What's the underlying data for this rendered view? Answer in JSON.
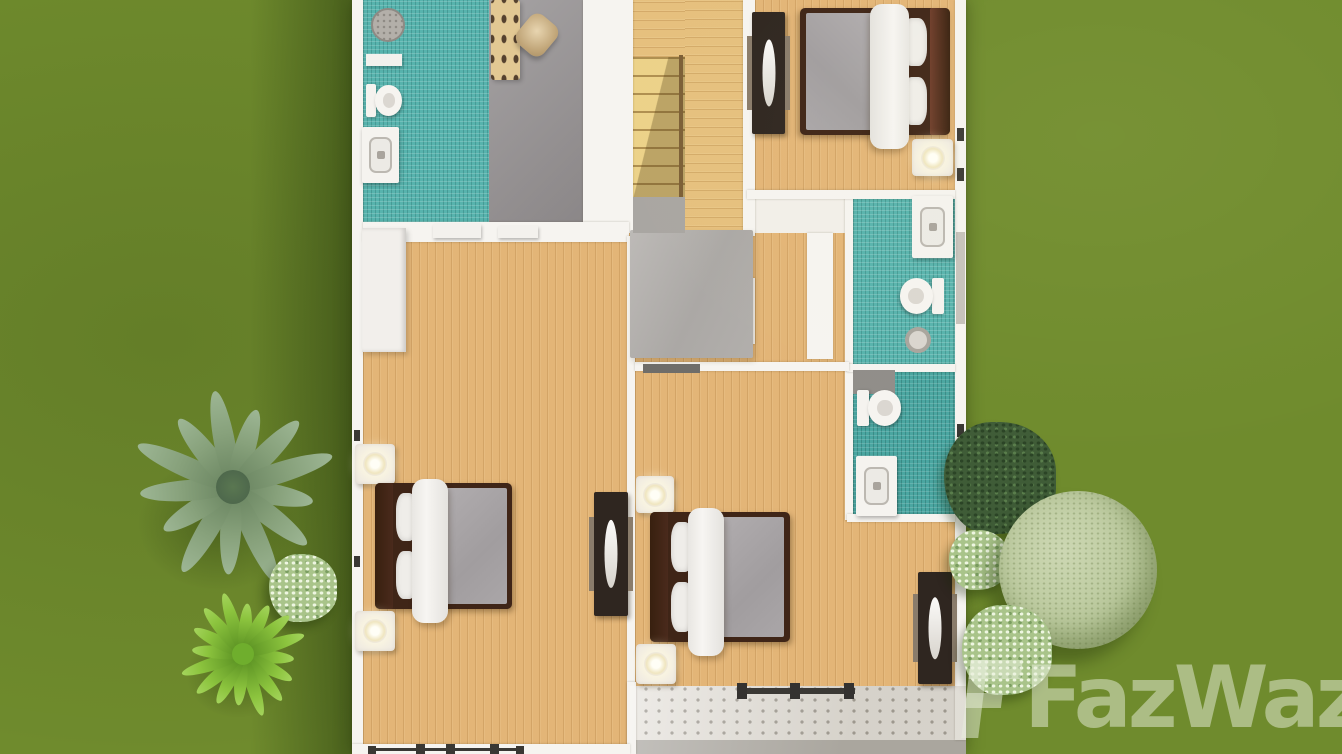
{
  "app": {
    "view": "3D floor plan, top-down view of upper storey with garden"
  },
  "watermark": {
    "text": "FazWaz",
    "color": "rgba(234,239,222,0.5)"
  },
  "palette": {
    "grass": "#6f8b2d",
    "wood": "#e3b577",
    "tile_teal": "#57b3ad",
    "tile_teal_dark": "#4aa6a1",
    "wall": "#f6f4f0",
    "gray_floor": "#9a9697",
    "bed_frame": "#3f2517",
    "headboard_brown": "#5f3424",
    "headboard_maroon": "#6e3c2a",
    "blanket_gray": "#a8a4a6",
    "console_dark": "#2f2620",
    "balcony_tile": "#eae7e2",
    "watermark": "rgba(234,239,222,0.5)"
  },
  "scene": {
    "width": 1342,
    "height": 754,
    "ground_shadow": {
      "x": 250,
      "y": 0,
      "w": 104,
      "h": 754
    },
    "house": {
      "x": 352,
      "y": 0,
      "w": 614,
      "h": 754
    },
    "rooms": [
      {
        "name": "bathroom-top-left",
        "floor": "teal",
        "x": 363,
        "y": 0,
        "w": 127,
        "h": 222
      },
      {
        "name": "walkin-closet",
        "floor": "gray",
        "x": 489,
        "y": 0,
        "w": 94,
        "h": 233
      },
      {
        "name": "stair-top-landing",
        "floor": "wood-h",
        "x": 633,
        "y": 0,
        "w": 52,
        "h": 57
      },
      {
        "name": "staircase",
        "floor": "stairs",
        "x": 633,
        "y": 57,
        "w": 52,
        "h": 143
      },
      {
        "name": "upper-hall",
        "floor": "wood-h",
        "x": 685,
        "y": 0,
        "w": 58,
        "h": 236
      },
      {
        "name": "bedroom-top-right",
        "floor": "wood-v",
        "x": 755,
        "y": 0,
        "w": 200,
        "h": 195
      },
      {
        "name": "hall-landing",
        "floor": "wood-v",
        "x": 627,
        "y": 233,
        "w": 226,
        "h": 140
      },
      {
        "name": "bedroom-left",
        "floor": "wood-v",
        "x": 363,
        "y": 242,
        "w": 264,
        "h": 512
      },
      {
        "name": "bedroom-middle",
        "floor": "wood-v",
        "x": 635,
        "y": 371,
        "w": 320,
        "h": 315
      },
      {
        "name": "bathroom-right-upper",
        "floor": "teal",
        "x": 853,
        "y": 197,
        "w": 102,
        "h": 170
      },
      {
        "name": "bathroom-right-lower",
        "floor": "teal2",
        "x": 853,
        "y": 372,
        "w": 102,
        "h": 144
      },
      {
        "name": "balcony",
        "floor": "dots",
        "x": 630,
        "y": 686,
        "w": 336,
        "h": 58
      },
      {
        "name": "balcony-edge",
        "floor": "edge",
        "x": 630,
        "y": 740,
        "w": 336,
        "h": 14
      }
    ],
    "walls": [
      {
        "name": "wall-left-exterior",
        "x": 352,
        "y": 0,
        "w": 11,
        "h": 754
      },
      {
        "name": "wall-right-exterior",
        "x": 955,
        "y": 0,
        "w": 11,
        "h": 740
      },
      {
        "name": "wall-closet-stairs",
        "x": 583,
        "y": 0,
        "w": 50,
        "h": 233
      },
      {
        "name": "wall-hall-bedroom-top",
        "x": 743,
        "y": 0,
        "w": 12,
        "h": 236
      },
      {
        "name": "wall-under-bathroom",
        "x": 363,
        "y": 222,
        "w": 266,
        "h": 20
      },
      {
        "name": "wall-bedrooms-divider",
        "x": 627,
        "y": 236,
        "w": 8,
        "h": 518
      },
      {
        "name": "wall-hall-bathroom",
        "x": 807,
        "y": 233,
        "w": 26,
        "h": 126
      },
      {
        "name": "wall-bathrooms-left",
        "x": 845,
        "y": 195,
        "w": 8,
        "h": 325
      },
      {
        "name": "wall-bedroom-top-bathroom",
        "x": 747,
        "y": 190,
        "w": 208,
        "h": 9
      },
      {
        "name": "wall-bathrooms-divider",
        "x": 847,
        "y": 364,
        "w": 108,
        "h": 8
      },
      {
        "name": "wall-bathroom-bedroom-mid",
        "x": 847,
        "y": 514,
        "w": 108,
        "h": 8
      },
      {
        "name": "wall-hall-bedroom-mid",
        "x": 635,
        "y": 362,
        "w": 214,
        "h": 9
      },
      {
        "name": "wall-balcony-left",
        "x": 627,
        "y": 682,
        "w": 9,
        "h": 72
      },
      {
        "name": "wall-bottom-left",
        "x": 352,
        "y": 744,
        "w": 278,
        "h": 10
      },
      {
        "name": "door-leaf",
        "x": 747,
        "y": 278,
        "w": 8,
        "h": 66
      }
    ],
    "deco": [
      {
        "name": "stair-banister",
        "cls": "banister",
        "x": 679,
        "y": 55,
        "w": 4,
        "h": 147
      },
      {
        "name": "door-threshold-a",
        "cls": "shelf",
        "x": 433,
        "y": 224,
        "w": 48,
        "h": 14
      },
      {
        "name": "door-threshold-b",
        "cls": "shelf",
        "x": 498,
        "y": 226,
        "w": 40,
        "h": 12
      },
      {
        "name": "window-band-right",
        "cls": "win-band",
        "x": 956,
        "y": 232,
        "w": 9,
        "h": 92
      },
      {
        "name": "window-post-1",
        "cls": "win-mark",
        "x": 368,
        "y": 746,
        "w": 8,
        "h": 8
      },
      {
        "name": "window-post-2",
        "cls": "win-mark",
        "x": 416,
        "y": 744,
        "w": 9,
        "h": 10
      },
      {
        "name": "window-post-3",
        "cls": "win-mark",
        "x": 446,
        "y": 744,
        "w": 9,
        "h": 10
      },
      {
        "name": "window-post-4",
        "cls": "win-mark",
        "x": 490,
        "y": 744,
        "w": 9,
        "h": 10
      },
      {
        "name": "window-post-5",
        "cls": "win-mark",
        "x": 516,
        "y": 746,
        "w": 8,
        "h": 8
      },
      {
        "name": "window-sill-bottom",
        "cls": "win-bar",
        "x": 368,
        "y": 748,
        "w": 156,
        "h": 3
      },
      {
        "name": "window-mark-right-1",
        "cls": "win-mark",
        "x": 957,
        "y": 128,
        "w": 7,
        "h": 13
      },
      {
        "name": "window-mark-right-2",
        "cls": "win-mark",
        "x": 957,
        "y": 168,
        "w": 7,
        "h": 13
      },
      {
        "name": "window-mark-right-3",
        "cls": "win-mark",
        "x": 957,
        "y": 424,
        "w": 7,
        "h": 13
      },
      {
        "name": "window-mark-right-4",
        "cls": "win-mark",
        "x": 957,
        "y": 500,
        "w": 7,
        "h": 12
      },
      {
        "name": "window-mark-left-1",
        "cls": "win-mark",
        "x": 354,
        "y": 430,
        "w": 6,
        "h": 11
      },
      {
        "name": "window-mark-left-2",
        "cls": "win-mark",
        "x": 354,
        "y": 556,
        "w": 6,
        "h": 11
      },
      {
        "name": "balcony-shade",
        "cls": "soft-shade",
        "x": 630,
        "y": 686,
        "w": 336,
        "h": 68
      }
    ],
    "furniture": [
      {
        "name": "shower-head-top-left",
        "kind": "shower",
        "x": 371,
        "y": 8,
        "w": 30,
        "h": 30
      },
      {
        "name": "bath-shelf-top-left",
        "kind": "rect",
        "cls": "shelf",
        "x": 366,
        "y": 54,
        "w": 36,
        "h": 12
      },
      {
        "name": "toilet-top-left",
        "kind": "toilet",
        "dir": "right",
        "x": 366,
        "y": 83,
        "w": 38,
        "h": 35
      },
      {
        "name": "sink-vanity-top-left",
        "kind": "vanity",
        "x": 362,
        "y": 127,
        "w": 37,
        "h": 56
      },
      {
        "name": "closet-bench",
        "kind": "bench",
        "x": 491,
        "y": 0,
        "w": 29,
        "h": 80
      },
      {
        "name": "closet-basket",
        "kind": "basket",
        "x": 520,
        "y": 16,
        "w": 34,
        "h": 38
      },
      {
        "name": "tv-console-bedroom-top",
        "kind": "console",
        "x": 752,
        "y": 12,
        "w": 33,
        "h": 122
      },
      {
        "name": "bed-bedroom-top",
        "kind": "bed",
        "head": "right",
        "hb": "#6e3c2a",
        "x": 800,
        "y": 8,
        "w": 150,
        "h": 127
      },
      {
        "name": "nightstand-bedroom-top",
        "kind": "stand",
        "x": 912,
        "y": 139,
        "w": 41,
        "h": 37
      },
      {
        "name": "sink-vanity-bath-upper",
        "kind": "vanity",
        "x": 912,
        "y": 196,
        "w": 41,
        "h": 62
      },
      {
        "name": "toilet-bath-upper",
        "kind": "toilet",
        "dir": "left",
        "x": 898,
        "y": 276,
        "w": 46,
        "h": 40
      },
      {
        "name": "floor-drain-bath-upper",
        "kind": "drain",
        "x": 905,
        "y": 327,
        "w": 26,
        "h": 26
      },
      {
        "name": "shower-pad-bath-lower",
        "kind": "rect",
        "cls": "shower-pad",
        "x": 853,
        "y": 370,
        "w": 42,
        "h": 24
      },
      {
        "name": "toilet-bath-lower",
        "kind": "toilet",
        "dir": "right",
        "x": 857,
        "y": 388,
        "w": 46,
        "h": 40
      },
      {
        "name": "sink-vanity-bath-lower",
        "kind": "vanity",
        "x": 856,
        "y": 456,
        "w": 41,
        "h": 60
      },
      {
        "name": "wardrobe-bedroom-left",
        "kind": "rect",
        "cls": "wardrobe",
        "x": 362,
        "y": 228,
        "w": 44,
        "h": 124
      },
      {
        "name": "rug-hall-landing",
        "kind": "rect",
        "cls": "rug",
        "x": 630,
        "y": 230,
        "w": 123,
        "h": 128
      },
      {
        "name": "stair-bottom-landing",
        "kind": "rect",
        "cls": "landing",
        "x": 633,
        "y": 197,
        "w": 52,
        "h": 36
      },
      {
        "name": "door-threshold-hall",
        "kind": "rect",
        "cls": "threshold",
        "x": 643,
        "y": 364,
        "w": 57,
        "h": 9
      },
      {
        "name": "nightstand-left-upper",
        "kind": "stand",
        "x": 355,
        "y": 444,
        "w": 40,
        "h": 40
      },
      {
        "name": "bed-bedroom-left",
        "kind": "bed",
        "head": "left",
        "hb": "#4a2a1c",
        "x": 375,
        "y": 483,
        "w": 137,
        "h": 126
      },
      {
        "name": "nightstand-left-lower",
        "kind": "stand",
        "x": 355,
        "y": 611,
        "w": 40,
        "h": 40
      },
      {
        "name": "tv-console-bedroom-left",
        "kind": "console",
        "x": 594,
        "y": 492,
        "w": 34,
        "h": 124
      },
      {
        "name": "nightstand-mid-upper",
        "kind": "stand",
        "x": 636,
        "y": 476,
        "w": 38,
        "h": 37
      },
      {
        "name": "bed-bedroom-middle",
        "kind": "bed",
        "head": "left",
        "hb": "#4a2a1c",
        "x": 650,
        "y": 512,
        "w": 140,
        "h": 130
      },
      {
        "name": "nightstand-mid-lower",
        "kind": "stand",
        "x": 636,
        "y": 644,
        "w": 40,
        "h": 40
      },
      {
        "name": "tv-console-bedroom-middle",
        "kind": "console",
        "x": 918,
        "y": 572,
        "w": 34,
        "h": 112
      },
      {
        "name": "balcony-railing",
        "kind": "railing",
        "x": 737,
        "y": 683,
        "w": 118,
        "h": 16
      }
    ],
    "landscape": [
      {
        "name": "palm-tree",
        "kind": "palm",
        "cx": 233,
        "cy": 487,
        "r": 104
      },
      {
        "name": "bush-flower-left",
        "kind": "bush",
        "variant": "light",
        "cx": 303,
        "cy": 588,
        "r": 34
      },
      {
        "name": "plant-bright-left",
        "kind": "plant",
        "cx": 243,
        "cy": 654,
        "r": 64
      },
      {
        "name": "bush-dark-right",
        "kind": "bush",
        "variant": "dark",
        "cx": 1000,
        "cy": 478,
        "r": 56
      },
      {
        "name": "bush-flower-right-upper",
        "kind": "bush",
        "variant": "light",
        "cx": 979,
        "cy": 560,
        "r": 30
      },
      {
        "name": "round-tree-right",
        "kind": "roundtree",
        "cx": 1078,
        "cy": 570,
        "r": 79
      },
      {
        "name": "bush-flower-right-lower",
        "kind": "bush",
        "variant": "light",
        "cx": 1007,
        "cy": 650,
        "r": 45
      }
    ]
  }
}
